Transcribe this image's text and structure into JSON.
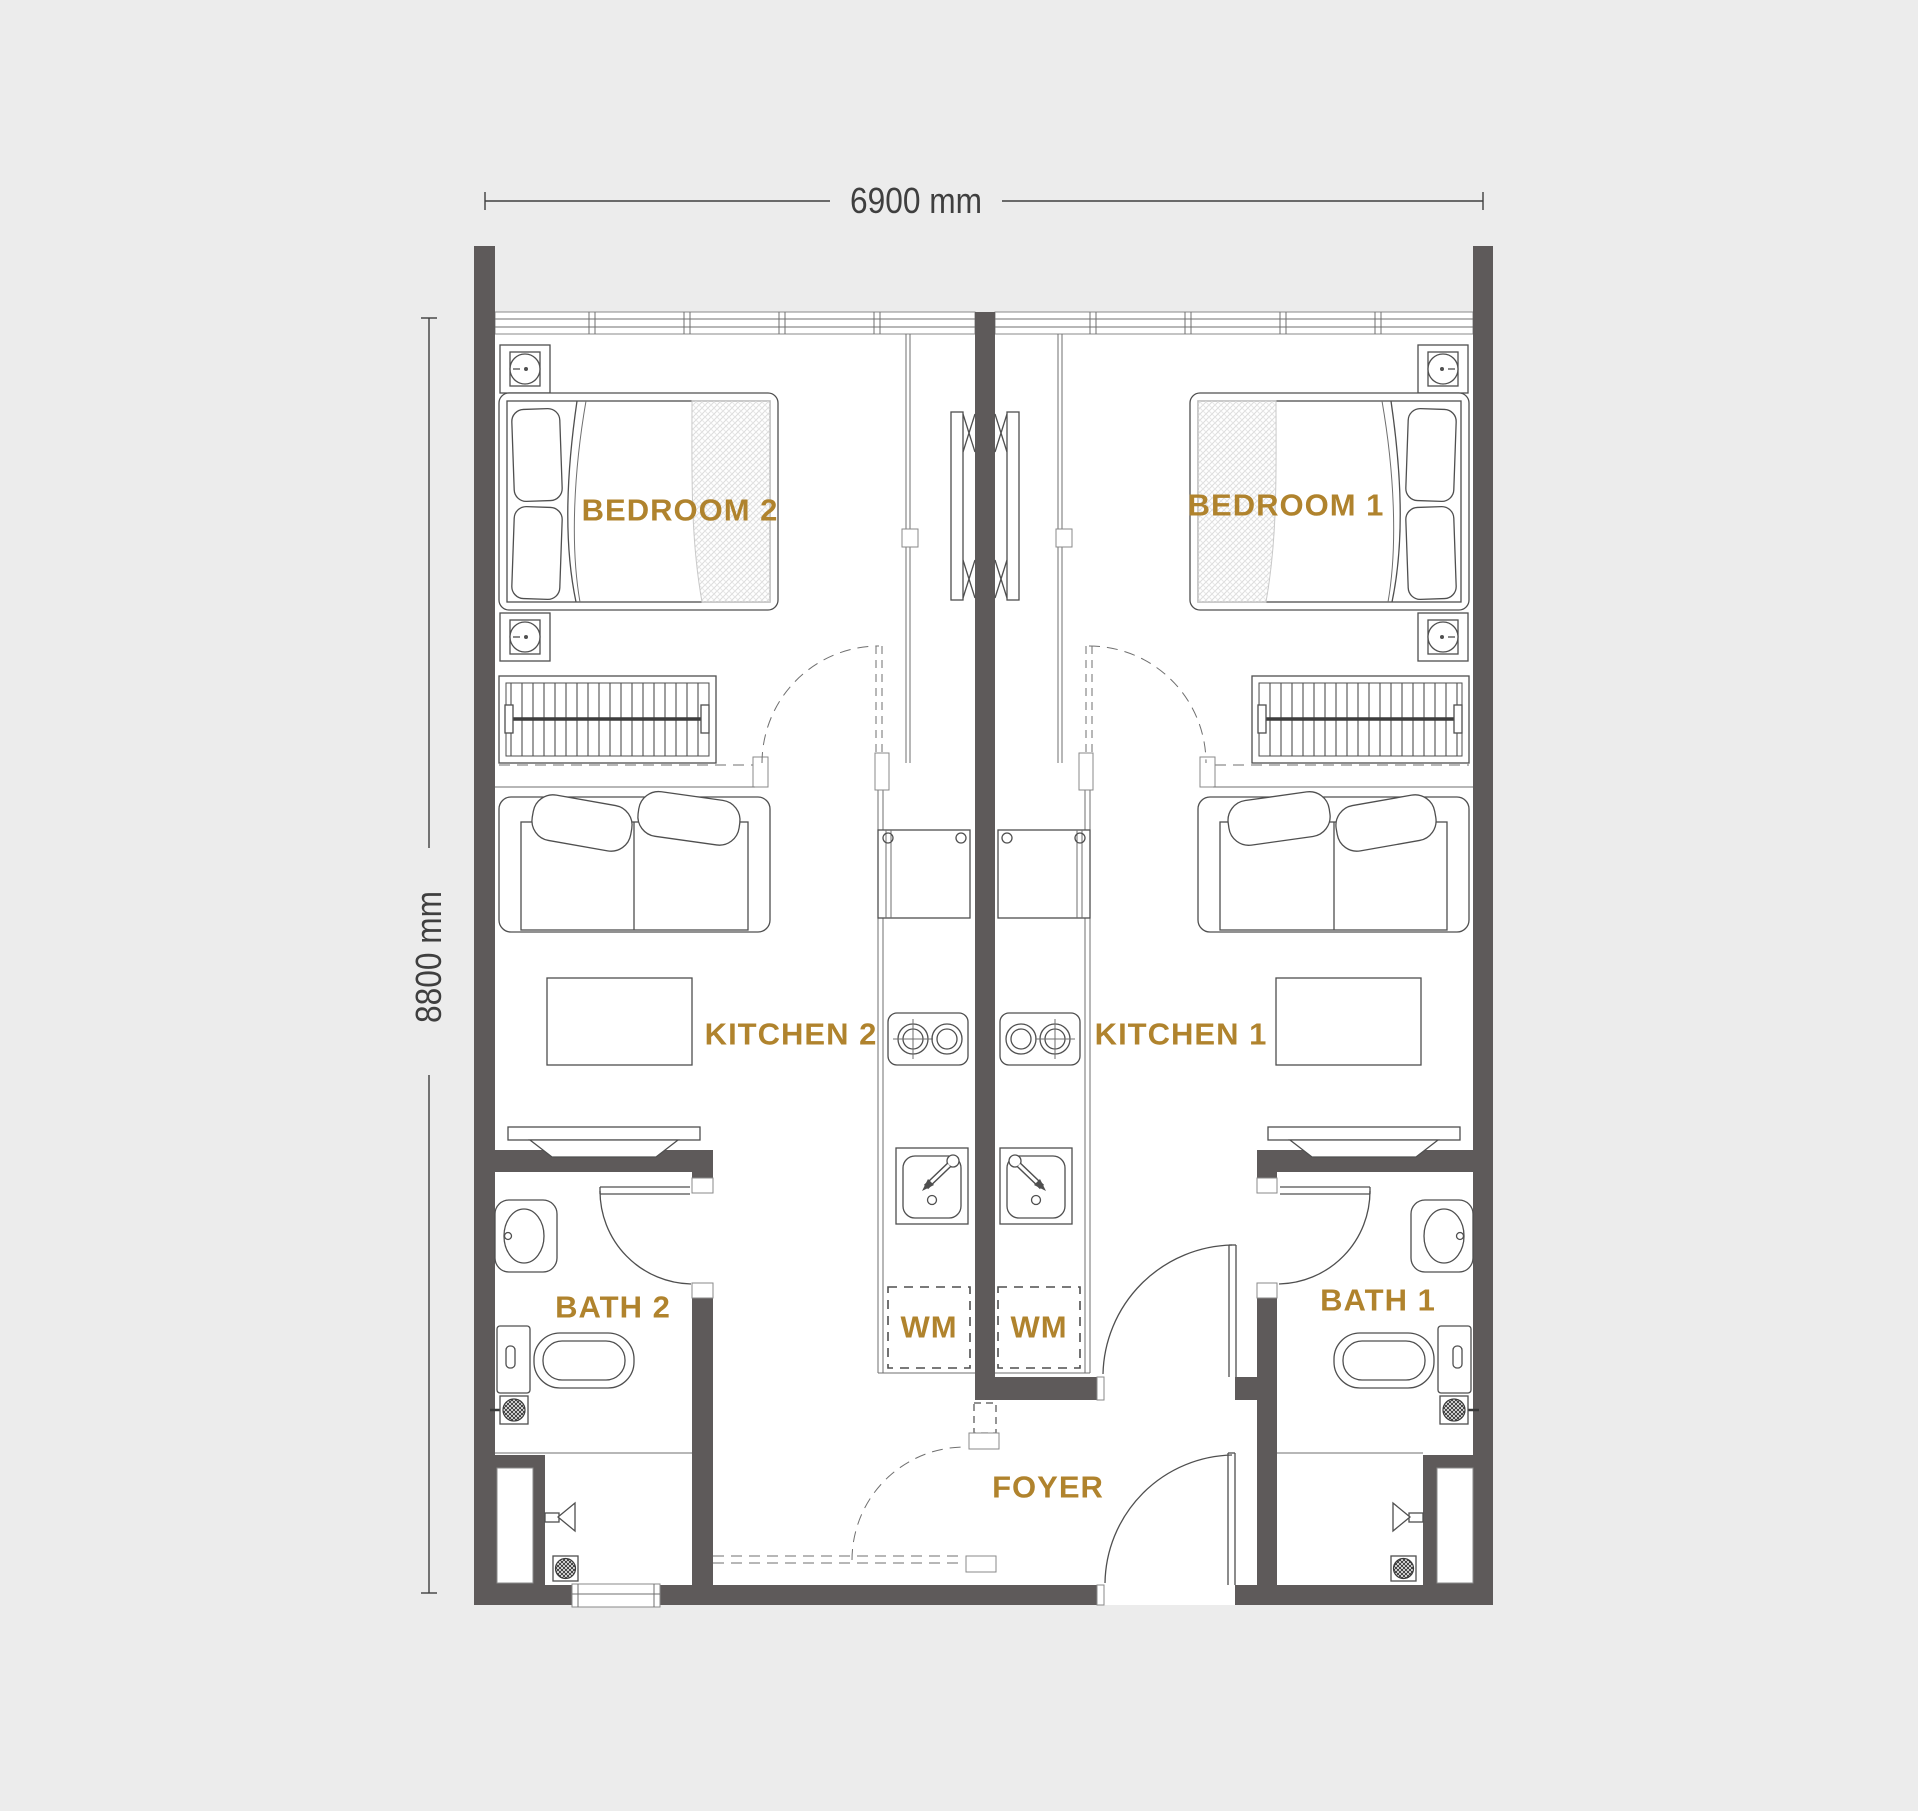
{
  "floorplan": {
    "dimensions": {
      "width_label": "6900 mm",
      "height_label": "8800 mm"
    },
    "rooms": {
      "bedroom_2": "BEDROOM 2",
      "bedroom_1": "BEDROOM 1",
      "kitchen_2": "KITCHEN 2",
      "kitchen_1": "KITCHEN 1",
      "bath_2": "BATH 2",
      "bath_1": "BATH 1",
      "foyer": "FOYER",
      "wm_left": "WM",
      "wm_right": "WM"
    },
    "colors": {
      "wall": "#5e5a5a",
      "label": "#b0832d",
      "dimension": "#3f3f3f",
      "background": "#ececec",
      "floor": "#ffffff",
      "line": "#4f4f4f"
    }
  }
}
